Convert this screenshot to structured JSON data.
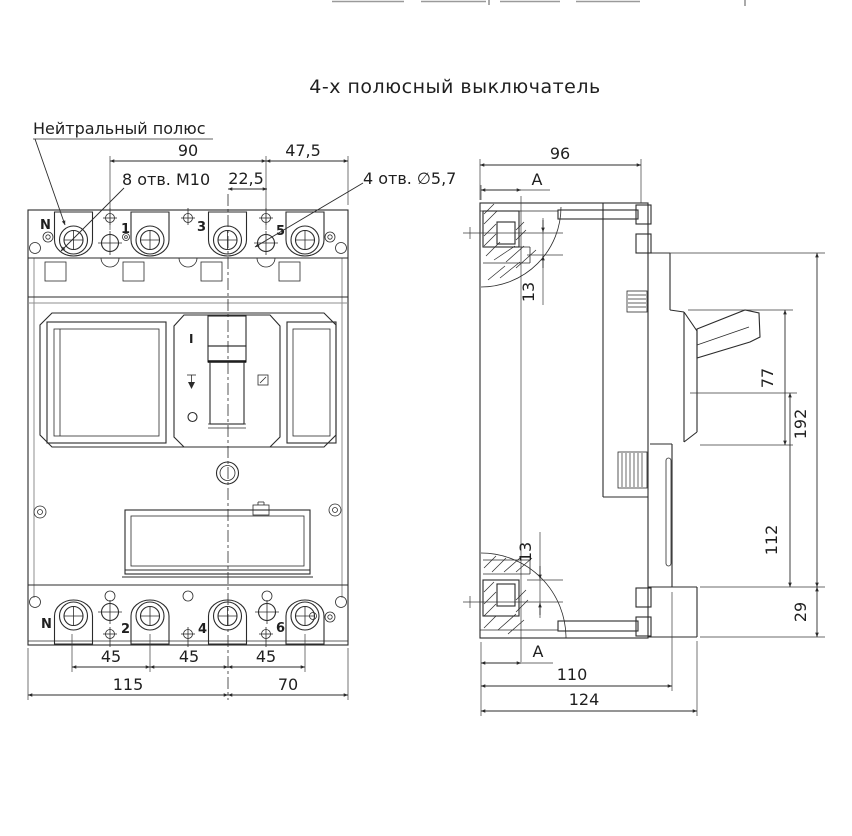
{
  "title": "4-х полюсный выключатель",
  "front_view": {
    "callout_neutral": "Нейтральный полюс",
    "callout_m10": "8 отв. М10",
    "callout_d57": "4 отв. ∅5,7",
    "poles_top": [
      "N",
      "1",
      "3",
      "5"
    ],
    "poles_bottom": [
      "N",
      "2",
      "4",
      "6"
    ],
    "handle_on": "I",
    "dim_90": "90",
    "dim_47_5": "47,5",
    "dim_22_5": "22,5",
    "dim_45": "45",
    "dim_115": "115",
    "dim_70": "70"
  },
  "side_view": {
    "section_label": "А",
    "dim_96": "96",
    "dim_13": "13",
    "dim_77": "77",
    "dim_192": "192",
    "dim_112": "112",
    "dim_29": "29",
    "dim_110": "110",
    "dim_124": "124"
  },
  "line_color": "#2b2b2b"
}
